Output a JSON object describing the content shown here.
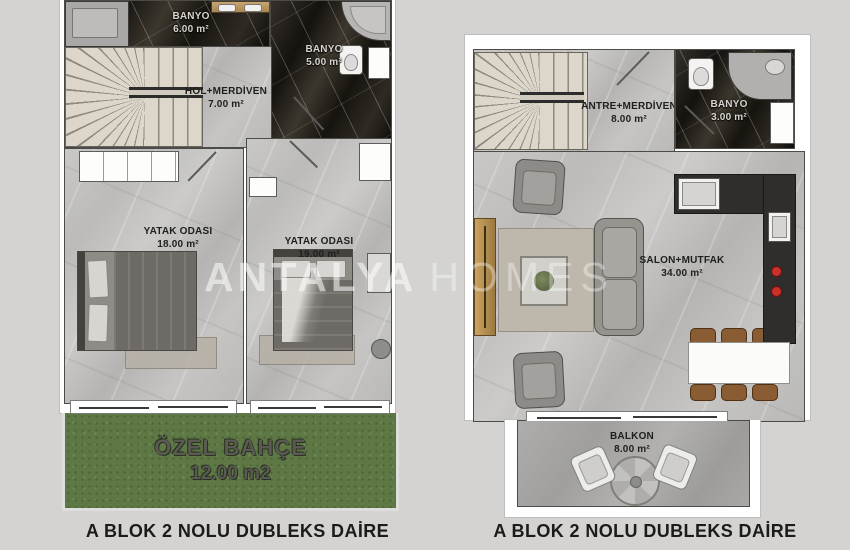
{
  "watermark": {
    "brand_bold": "ANTALYA",
    "brand_light": "HOMES"
  },
  "colors": {
    "background": "#d4d3d1",
    "wall_white": "#ffffff",
    "floor_light_marble": "#c3c2c0",
    "floor_dark_marble": "#211e1b",
    "garden_green": "#5e7845",
    "stair_beige": "#ddd7cb",
    "wood_tan": "#bd9a62",
    "dining_chair_brown": "#8a5c33",
    "stove_red": "#c8312b"
  },
  "left_plan": {
    "caption": "A BLOK 2 NOLU DUBLEKS DAİRE",
    "rooms": {
      "banyo_ust": {
        "name": "BANYO",
        "area": "6.00 m²"
      },
      "banyo_kucuk": {
        "name": "BANYO",
        "area": "5.00 m²"
      },
      "hol": {
        "name": "HOL+MERDİVEN",
        "area": "7.00 m²"
      },
      "yatak1": {
        "name": "YATAK ODASI",
        "area": "18.00 m²"
      },
      "yatak2": {
        "name": "YATAK ODASI",
        "area": "19.00 m²"
      },
      "bahce": {
        "name": "ÖZEL BAHÇE",
        "area": "12.00 m2"
      }
    }
  },
  "right_plan": {
    "caption": "A BLOK 2 NOLU DUBLEKS DAİRE",
    "rooms": {
      "antre": {
        "name": "ANTRE+MERDİVEN",
        "area": "8.00 m²"
      },
      "banyo": {
        "name": "BANYO",
        "area": "3.00 m²"
      },
      "salon": {
        "name": "SALON+MUTFAK",
        "area": "34.00 m²"
      },
      "balkon": {
        "name": "BALKON",
        "area": "8.00 m²"
      }
    }
  }
}
